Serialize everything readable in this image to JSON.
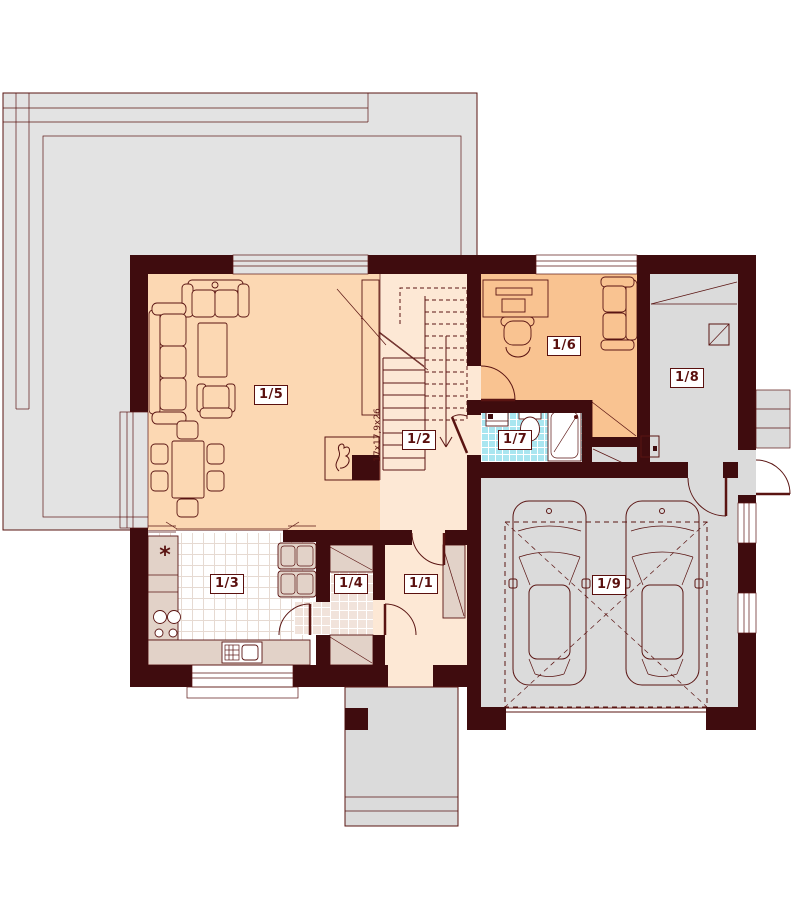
{
  "plan": {
    "rooms": [
      {
        "label": "1/1"
      },
      {
        "label": "1/2"
      },
      {
        "label": "1/3"
      },
      {
        "label": "1/4"
      },
      {
        "label": "1/5"
      },
      {
        "label": "1/6"
      },
      {
        "label": "1/7"
      },
      {
        "label": "1/8"
      },
      {
        "label": "1/9"
      }
    ],
    "stairs": {
      "dimension_label": "17x17,9x26"
    },
    "kitchen": {
      "appliance_symbol": "*"
    },
    "colors": {
      "wall": "#3F0C0E",
      "line": "#5A1412",
      "label_text": "#5A100E",
      "floor_living": "#FCD8B3",
      "floor_hall": "#FDE8D5",
      "floor_study": "#F9C391",
      "tile_bath": "#A9E6F0",
      "tile_bath_line": "#FFFFFF",
      "tile_kitchen": "#FFFFFF",
      "tile_kitchen_line": "#E6DAD2",
      "tile_pantry": "#F1E3DB",
      "counter": "#E2D2C8",
      "concrete": "#DBDBDB",
      "terrace": "#E3E3E3"
    }
  }
}
